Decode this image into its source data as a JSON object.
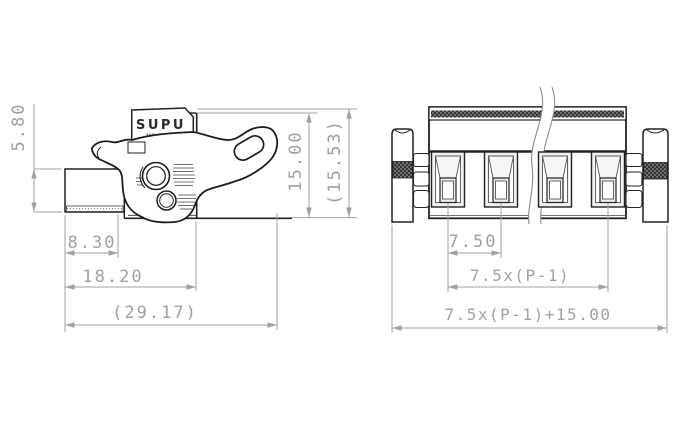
{
  "drawing": {
    "brand": "SUPU",
    "model_marking": "MC 253-S",
    "side_view": {
      "dims": {
        "wire_entry_height": "5.80",
        "front_depth": "8.30",
        "housing_depth": "18.20",
        "overall_depth_ref": "(29.17)",
        "housing_height": "15.00",
        "overall_height_ref": "(15.53)"
      }
    },
    "front_view": {
      "dims": {
        "pole_pitch": "7.50",
        "pole_span_formula": "7.5x(P-1)",
        "overall_width_formula": "7.5x(P-1)+15.00"
      }
    }
  }
}
